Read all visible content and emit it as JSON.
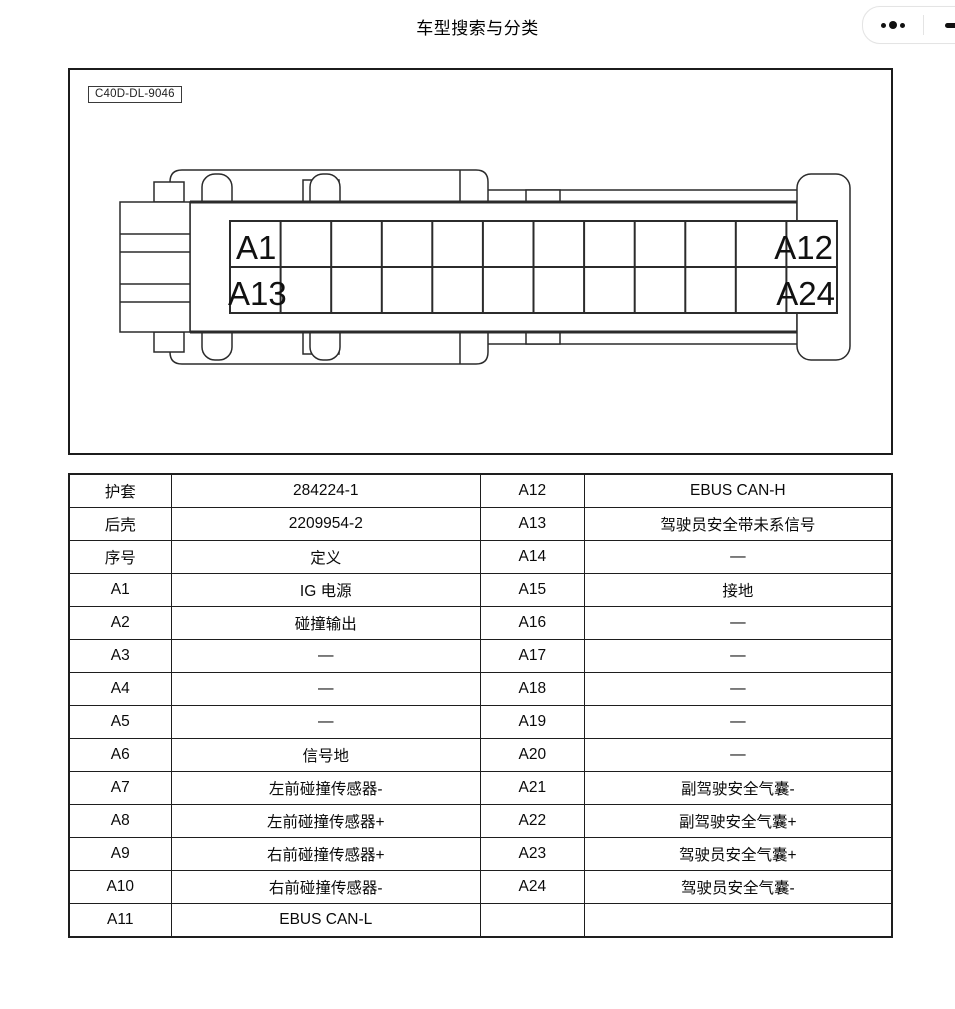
{
  "header": {
    "title": "车型搜索与分类"
  },
  "capsule": {
    "more_icon": "ellipsis-dots",
    "minimize_icon": "dash"
  },
  "diagram": {
    "part_number": "C40D-DL-9046",
    "grid": {
      "columns": 12,
      "rows": 2
    },
    "pins": {
      "first_top": "A1",
      "last_top": "A12",
      "first_bottom": "A13",
      "last_bottom": "A24"
    }
  },
  "pin_table": {
    "rows": [
      [
        "护套",
        "284224-1",
        "A12",
        "EBUS CAN-H"
      ],
      [
        "后壳",
        "2209954-2",
        "A13",
        "驾驶员安全带未系信号"
      ],
      [
        "序号",
        "定义",
        "A14",
        "—"
      ],
      [
        "A1",
        "IG 电源",
        "A15",
        "接地"
      ],
      [
        "A2",
        "碰撞输出",
        "A16",
        "—"
      ],
      [
        "A3",
        "—",
        "A17",
        "—"
      ],
      [
        "A4",
        "—",
        "A18",
        "—"
      ],
      [
        "A5",
        "—",
        "A19",
        "—"
      ],
      [
        "A6",
        "信号地",
        "A20",
        "—"
      ],
      [
        "A7",
        "左前碰撞传感器-",
        "A21",
        "副驾驶安全气囊-"
      ],
      [
        "A8",
        "左前碰撞传感器+",
        "A22",
        "副驾驶安全气囊+"
      ],
      [
        "A9",
        "右前碰撞传感器+",
        "A23",
        "驾驶员安全气囊+"
      ],
      [
        "A10",
        "右前碰撞传感器-",
        "A24",
        "驾驶员安全气囊-"
      ],
      [
        "A11",
        "EBUS CAN-L",
        "",
        ""
      ]
    ]
  }
}
